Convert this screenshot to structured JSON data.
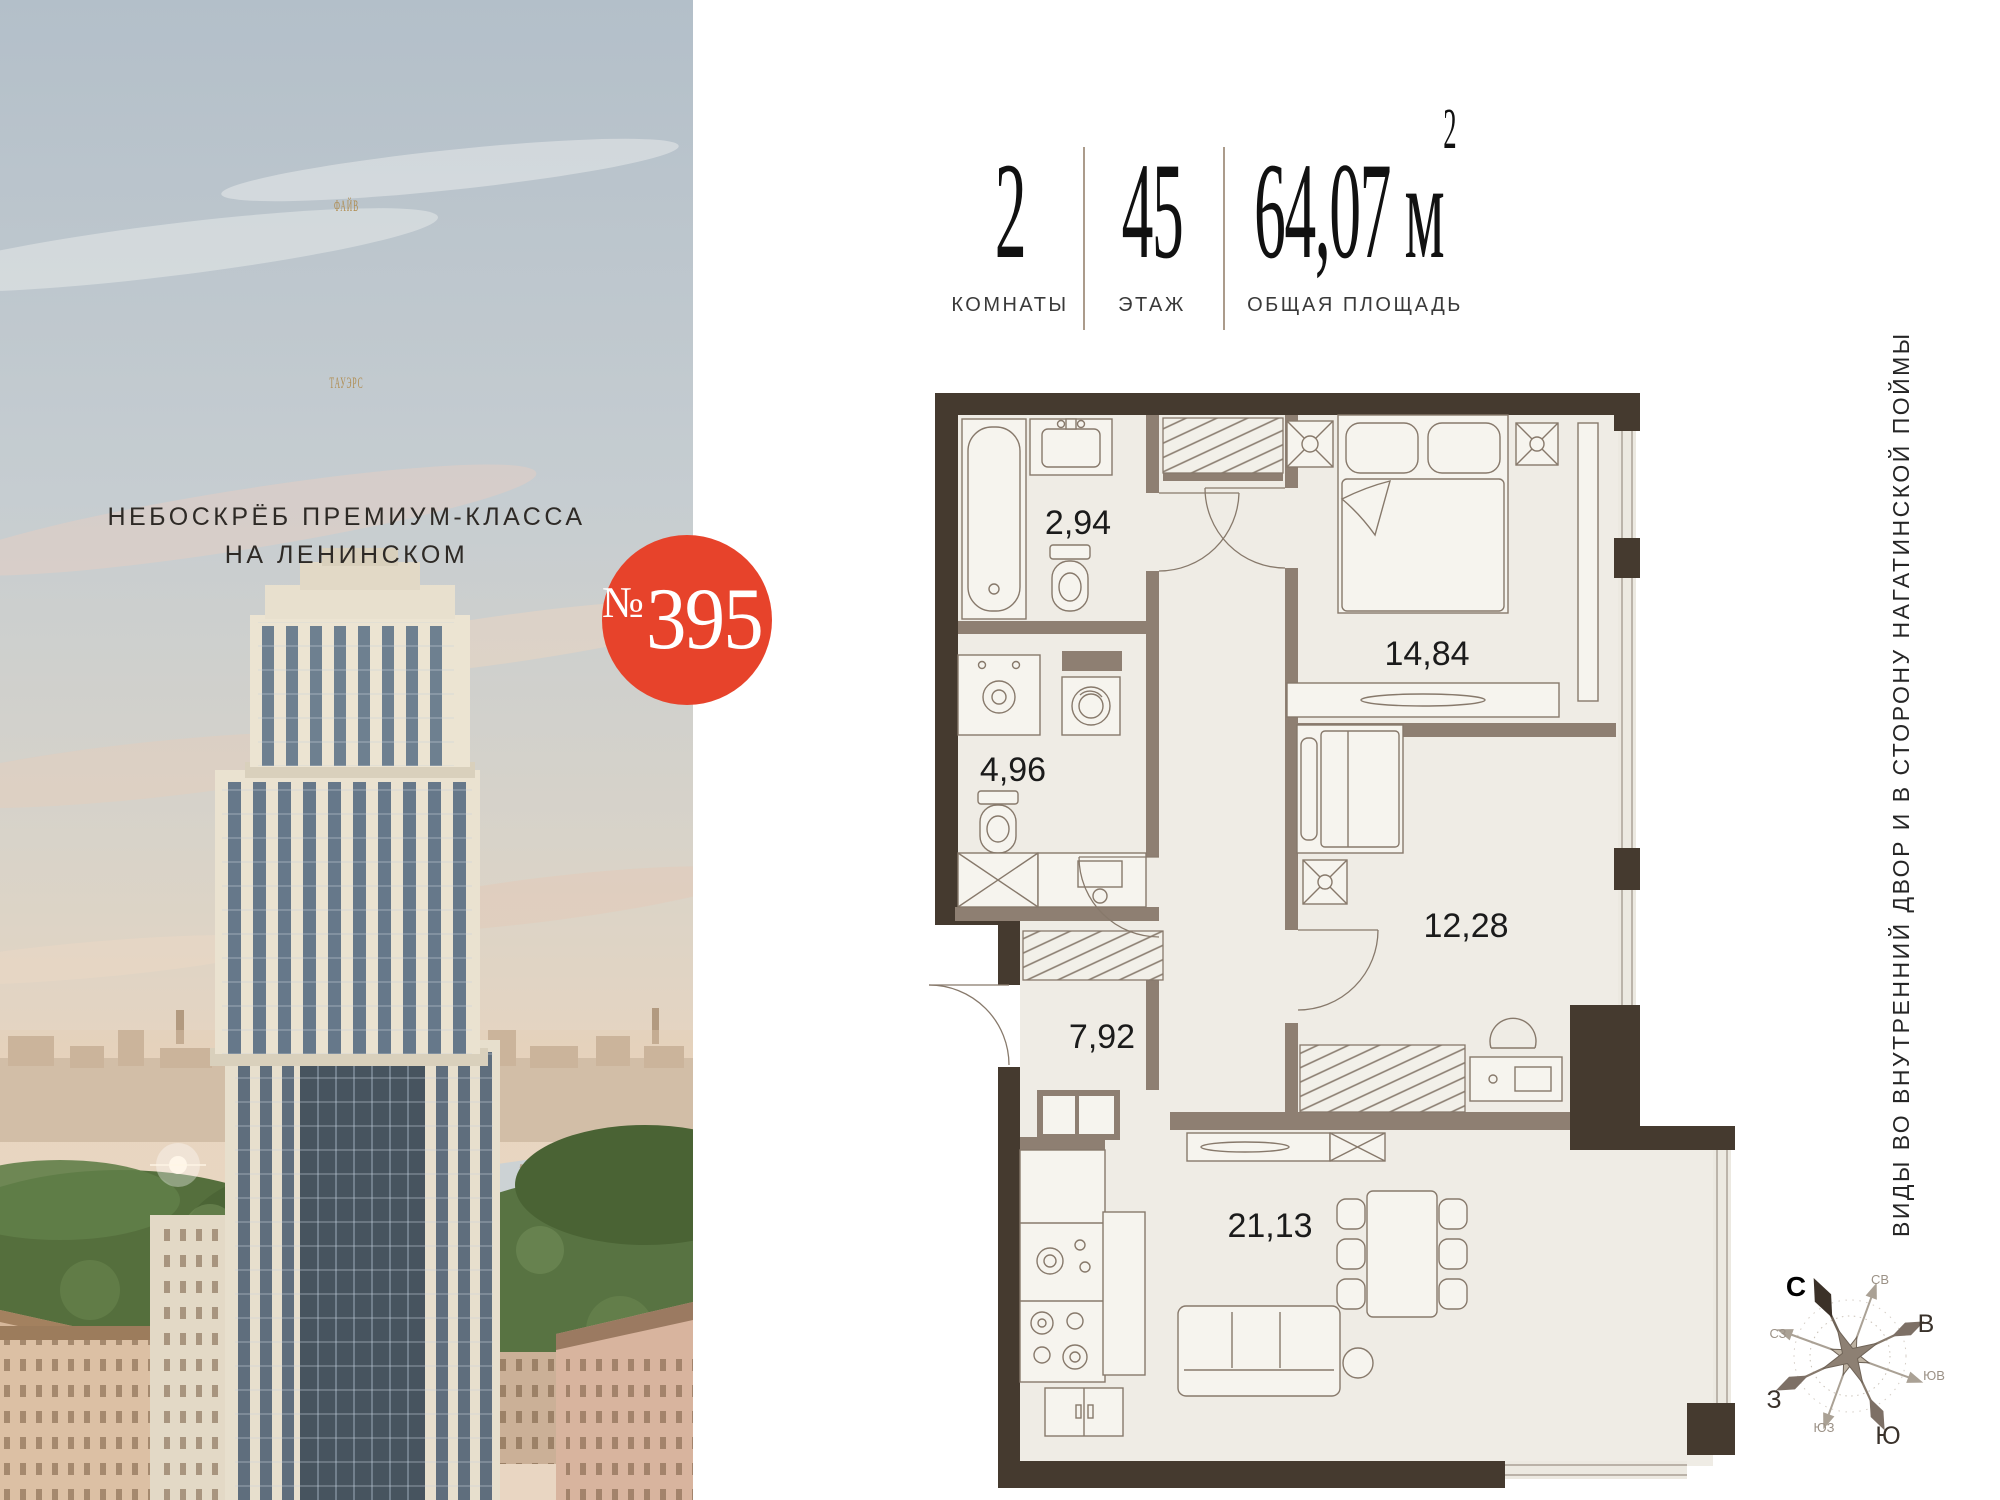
{
  "brand": {
    "title_line1": "ФАЙВ",
    "title_line2": "ТАУЭРС",
    "subtitle_line1": "НЕБОСКРЁБ ПРЕМИУМ-КЛАССА",
    "subtitle_line2": "НА ЛЕНИНСКОМ"
  },
  "badge": {
    "number_sign": "№",
    "number": "395"
  },
  "stats": {
    "rooms": {
      "value": "2",
      "label": "КОМНАТЫ"
    },
    "floor": {
      "value": "45",
      "label": "ЭТАЖ"
    },
    "area": {
      "value": "64,07 м",
      "sup": "2",
      "label": "ОБЩАЯ ПЛОЩАДЬ"
    }
  },
  "floorplan": {
    "rooms": [
      {
        "id": "bathroom",
        "area": "2,94"
      },
      {
        "id": "washroom",
        "area": "4,96"
      },
      {
        "id": "hallway",
        "area": "7,92"
      },
      {
        "id": "bedroom-1",
        "area": "14,84"
      },
      {
        "id": "bedroom-2",
        "area": "12,28"
      },
      {
        "id": "living-kitchen",
        "area": "21,13"
      }
    ]
  },
  "side_note": "ВИДЫ ВО ВНУТРЕННИЙ ДВОР И В СТОРОНУ НАГАТИНСКОЙ ПОЙМЫ",
  "compass": {
    "north": "С",
    "northeast": "СВ",
    "east": "В",
    "southeast": "ЮВ",
    "south": "Ю",
    "southwest": "ЮЗ",
    "west": "З",
    "northwest": "СЗ"
  },
  "colors": {
    "accent_red": "#e7432b",
    "brand_gold": "#b08c4f",
    "wall_dark": "#453a2f",
    "wall_light": "#8e7f72",
    "floor": "#efece5"
  }
}
